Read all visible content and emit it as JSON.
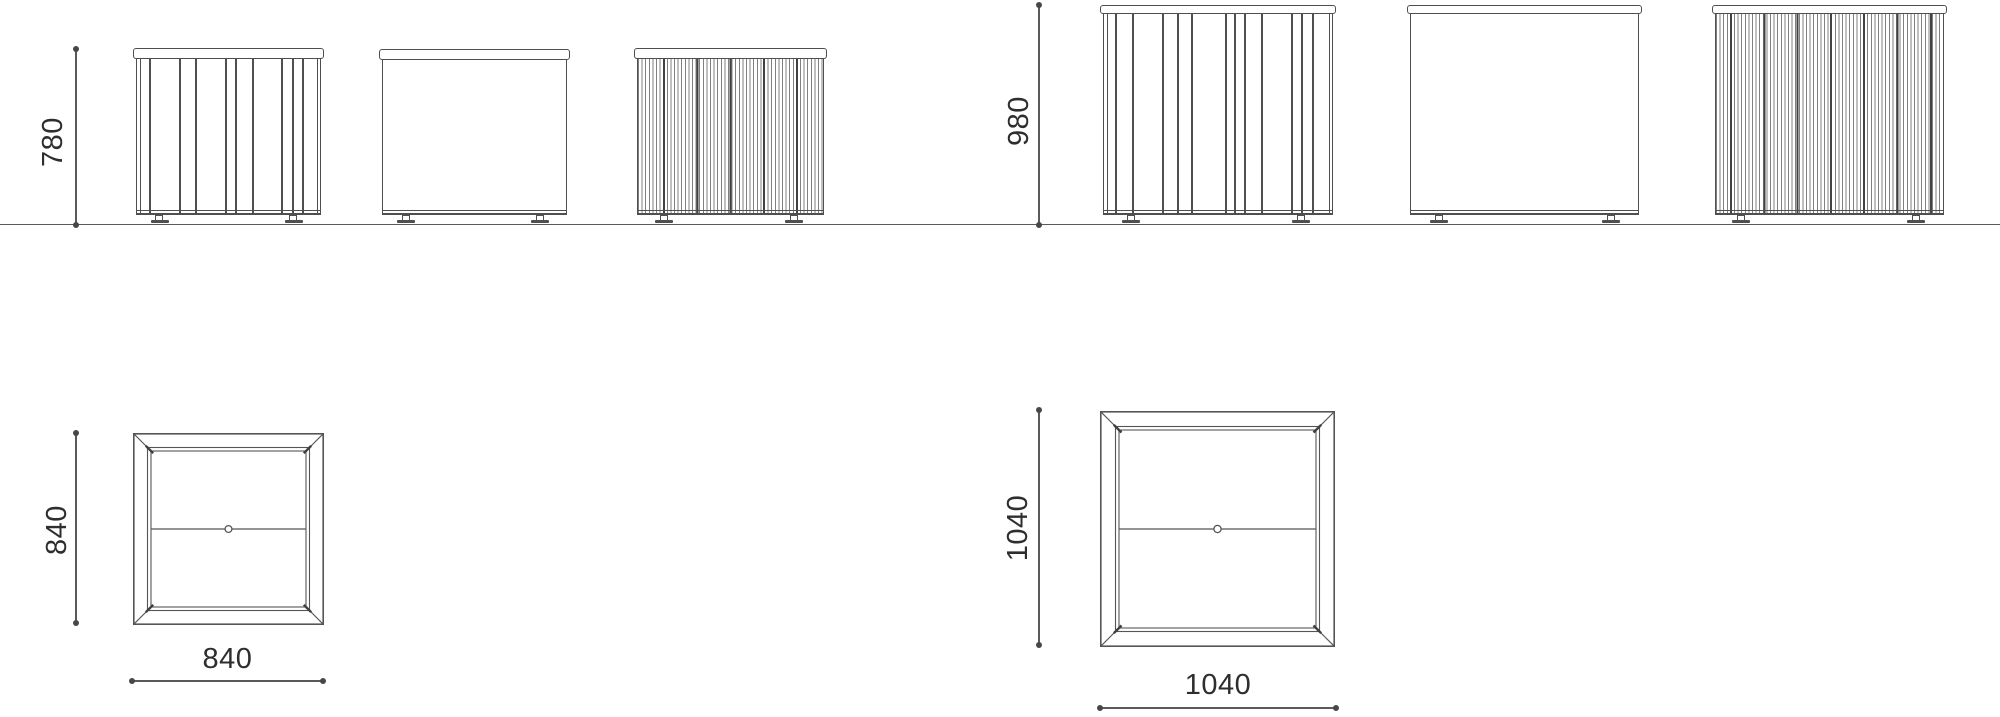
{
  "elevations": {
    "groups": [
      {
        "height_label": "780",
        "views": [
          {
            "type": "slatted-front-elevation"
          },
          {
            "type": "plain-side-elevation"
          },
          {
            "type": "ribbed-back-elevation"
          }
        ]
      },
      {
        "height_label": "980",
        "views": [
          {
            "type": "slatted-front-elevation"
          },
          {
            "type": "plain-side-elevation"
          },
          {
            "type": "ribbed-back-elevation"
          }
        ]
      }
    ]
  },
  "plans": [
    {
      "depth_label": "840",
      "width_label": "840"
    },
    {
      "depth_label": "1040",
      "width_label": "1040"
    }
  ],
  "colors": {
    "line": "#555555",
    "text": "#2e2e2e",
    "background": "#ffffff"
  }
}
